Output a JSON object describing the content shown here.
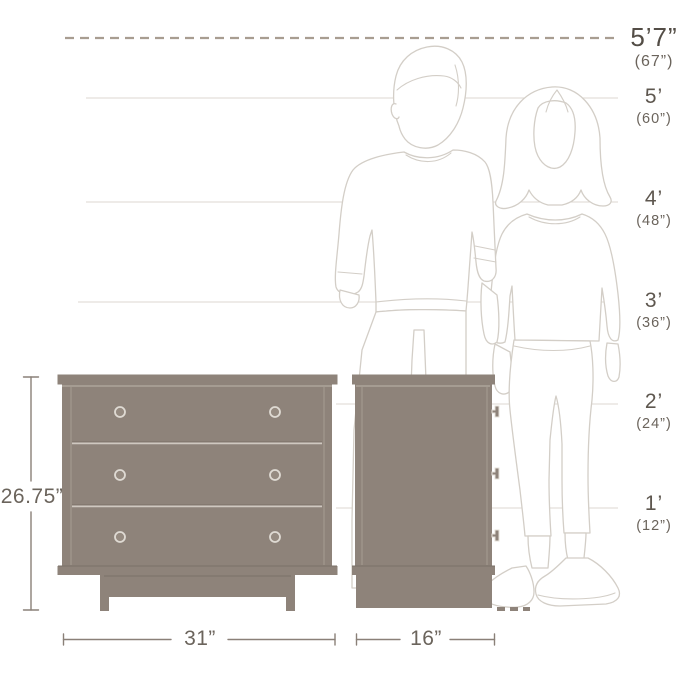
{
  "title": "Dresser size diagram with human figures for scale",
  "height_scale": {
    "markers": [
      {
        "feet": "5’7”",
        "inches": "(67”)"
      },
      {
        "feet": "5’",
        "inches": "(60”)"
      },
      {
        "feet": "4’",
        "inches": "(48”)"
      },
      {
        "feet": "3’",
        "inches": "(36”)"
      },
      {
        "feet": "2’",
        "inches": "(24”)"
      },
      {
        "feet": "1’",
        "inches": "(12”)"
      }
    ]
  },
  "dresser": {
    "height_label": "26.75”",
    "width_label": "31”",
    "depth_label": "16”",
    "drawer_count": 3
  },
  "colors": {
    "furniture": "#8e837a",
    "figure_outline": "#d3cec7",
    "gridline": "#dcd7d0",
    "dashed_reference_line": "#a89d91",
    "dimension_line": "#8a8078",
    "label_text": "#5e574f"
  }
}
